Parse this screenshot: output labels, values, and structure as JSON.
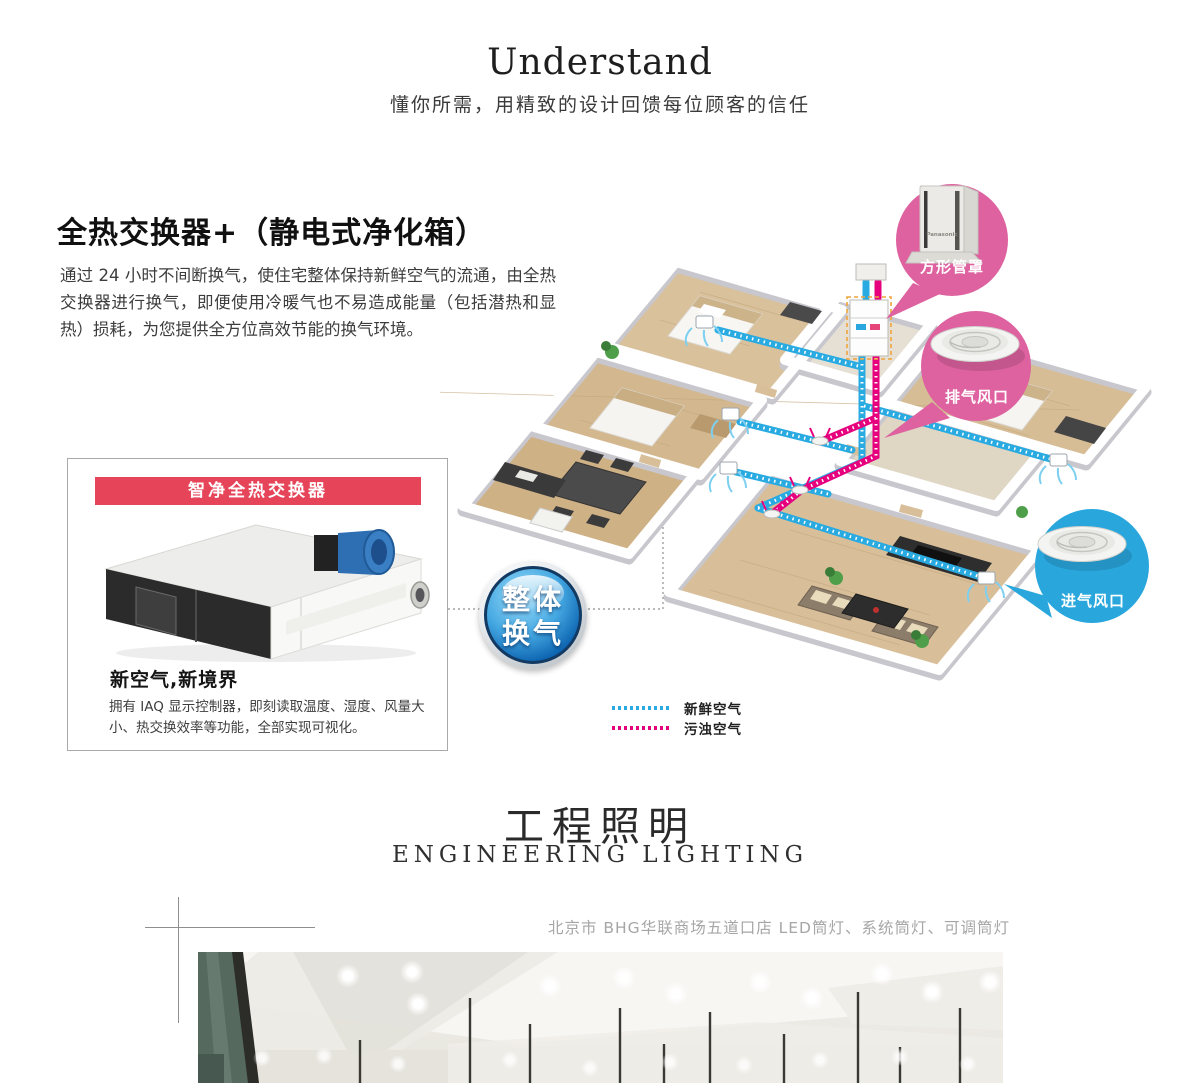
{
  "header": {
    "title": "Understand",
    "subtitle": "懂你所需，用精致的设计回馈每位顾客的信任"
  },
  "section": {
    "heading": "全热交换器+（静电式净化箱）",
    "body": "通过 24 小时不间断换气，使住宅整体保持新鲜空气的流通，由全热交换器进行换气，即便使用冷暖气也不易造成能量（包括潜热和显热）损耗，为您提供全方位高效节能的换气环境。"
  },
  "product_box": {
    "banner": "智净全热交换器",
    "title": "新空气,新境界",
    "description": "拥有 IAQ 显示控制器，即刻读取温度、湿度、风量大小、热交换效率等功能，全部实现可视化。"
  },
  "diagram": {
    "badge_line1": "整体",
    "badge_line2": "换气",
    "callout_square_duct": "方形管罩",
    "callout_exhaust": "排气风口",
    "callout_intake": "进气风口",
    "product_logo": "Panasonic",
    "legend_fresh": "新鲜空气",
    "legend_dirty": "污浊空气"
  },
  "lighting": {
    "title_cn": "工程照明",
    "title_en": "ENGINEERING LIGHTING",
    "caption": "北京市 BHG华联商场五道口店 LED筒灯、系统筒灯、可调筒灯"
  },
  "colors": {
    "accent_red": "#e64458",
    "bubble_pink": "#de62a0",
    "bubble_blue": "#29a7dd",
    "flow_fresh": "#29abe2",
    "flow_dirty": "#e6007e"
  }
}
